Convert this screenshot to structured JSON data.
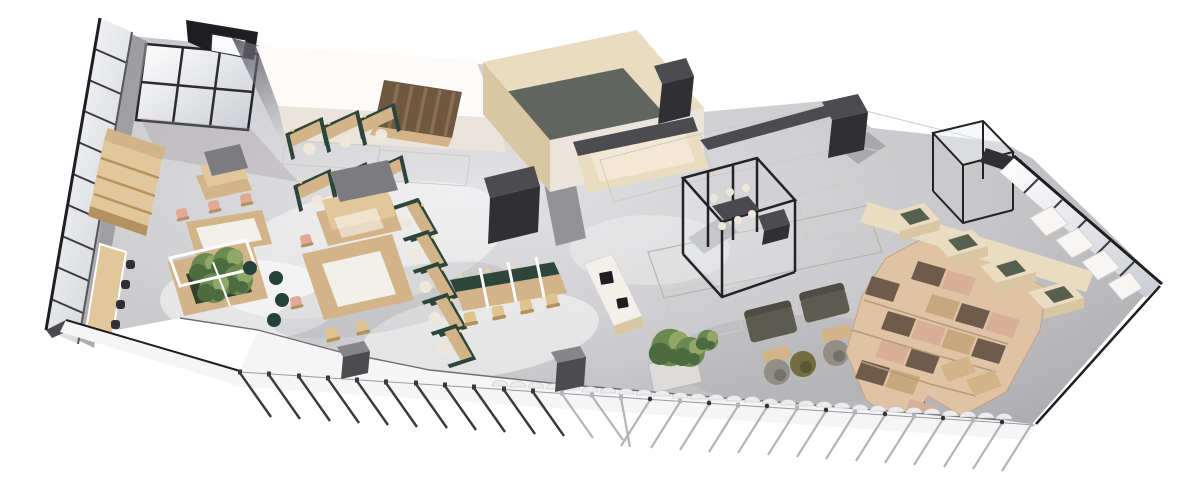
{
  "palette": {
    "background": "#ffffff",
    "floor": "#c9c8ca",
    "floor_light": "#e3e2e4",
    "floor_dark": "#a9a8ac",
    "balcony_white": "#f6f5f5",
    "wall_white": "#f8f6f4",
    "wall_warm": "#eae4dc",
    "wall_shadow": "#d6cfc7",
    "roof_white": "#fcfbfa",
    "edge_dark": "#1e1e22",
    "charcoal": "#2f2f34",
    "dark_gray": "#4b4b50",
    "mid_gray": "#86868a",
    "slate_roof": "#61655f",
    "beige_wall": "#e9dcc0",
    "beige_shadow": "#d9c7a3",
    "wood": "#d2b488",
    "wood_light": "#e2c79b",
    "wood_dark": "#b3925f",
    "stair_wood": "#6f5740",
    "stair_step": "#8a6f53",
    "partition_green": "#2c463c",
    "chair_green": "#24413a",
    "plant_green": "#6a8a52",
    "plant_dark": "#4c6b3e",
    "plant_light": "#8fa868",
    "planter_dark": "#33402f",
    "planter_white": "#dddcda",
    "blush": "#e2a795",
    "cream": "#efe8da",
    "chair_tan": "#dfc490",
    "sofa_olive": "#5b5b50",
    "sofa_dark": "#4d4d44",
    "pod_taupe": "#928d85",
    "pod_olive": "#716d3f",
    "pod_navy": "#4c5162",
    "tile_wood": "#e0c3a5",
    "tile_blush": "#d7af99",
    "tile_pattern": "#6f5b4b",
    "niche_cushion": "#57604f",
    "glass": "#eef1f4",
    "glass_shade": "#c9ccd2",
    "frame_black": "#232327",
    "counter_white": "#f3f0ec",
    "appliance_black": "#1f1f22",
    "canopy_gray": "#7b7b80",
    "mat_gray": "#56565a",
    "post_dark": "#3a3a3d",
    "post_silver": "#b4b4b8",
    "light_warm": "#f2d98c"
  },
  "counts": {
    "railing_posts": 28
  }
}
